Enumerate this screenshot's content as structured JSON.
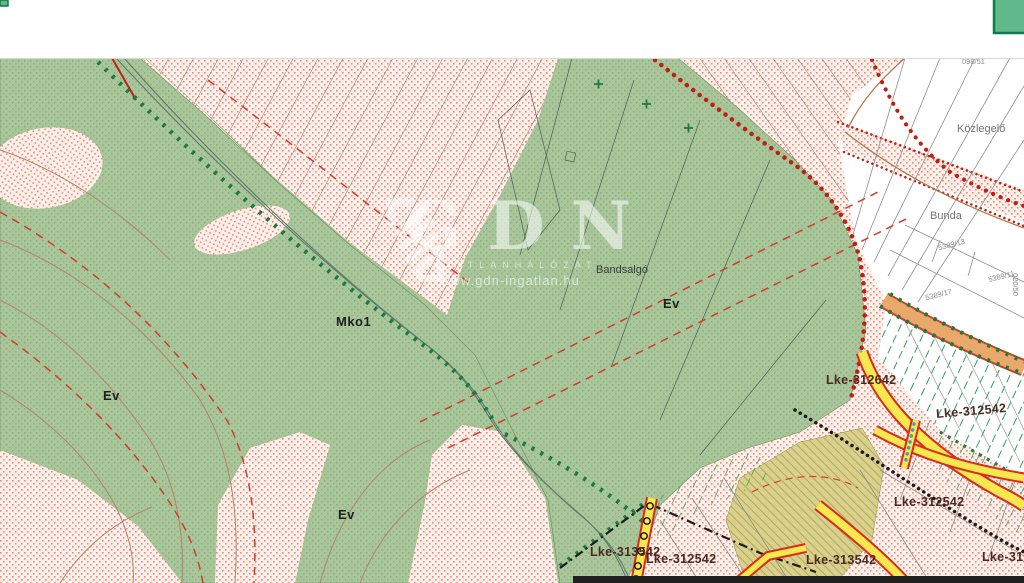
{
  "map": {
    "watermark": {
      "title": "GDN",
      "subtitle": "INGATLANHÁLÓZAT",
      "url": "www.gdn-ingatlan.hu"
    },
    "zone_labels": [
      {
        "id": "mko1",
        "text": "Mko1"
      },
      {
        "id": "ev-left",
        "text": "Ev"
      },
      {
        "id": "ev-center",
        "text": "Ev"
      },
      {
        "id": "ev-bottom",
        "text": "Ev"
      },
      {
        "id": "bandsalgo",
        "text": "Bandsalgó"
      },
      {
        "id": "kozlegelo",
        "text": "Közlegelő"
      },
      {
        "id": "bunda",
        "text": "Bunda"
      },
      {
        "id": "lke-312642",
        "text": "Lke-312642"
      },
      {
        "id": "lke-312542-a",
        "text": "Lke-312542"
      },
      {
        "id": "lke-312542-b",
        "text": "Lke-312542"
      },
      {
        "id": "lke-313542-a",
        "text": "Lke-313542"
      },
      {
        "id": "lke-312542-c",
        "text": "Lke-312542"
      },
      {
        "id": "lke-313542-b",
        "text": "Lke-313542"
      },
      {
        "id": "lke-312-clipped",
        "text": "Lke-312"
      }
    ],
    "parcel_labels": [
      {
        "text": "098/51"
      },
      {
        "text": "5389/13"
      },
      {
        "text": "5389/11"
      },
      {
        "text": "5389/17"
      },
      {
        "text": "020/50"
      }
    ],
    "colors": {
      "forest_green": "#a9c69b",
      "stipple_red": "#e4705a",
      "boundary_dot_red": "#c21f14",
      "zone_dash_red": "#d23b2e",
      "road_yellow": "#f6e84e",
      "road_casing_red": "#d92b1f",
      "road_orange": "#e8a96a",
      "hatch_green": "#2f9e57",
      "forest_edge_green": "#1c7a40",
      "admin_boundary_black": "#1b1b1b",
      "olive_zone": "#d8d08c",
      "topbar_white": "#ffffff",
      "corner_green": "#5fb98a"
    }
  }
}
